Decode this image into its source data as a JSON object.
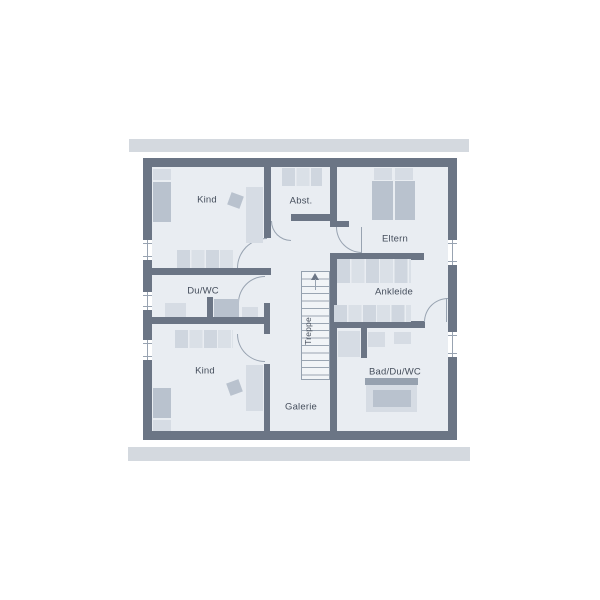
{
  "rooms": {
    "kind_top": {
      "label": "Kind"
    },
    "abstellraum": {
      "label": "Abst."
    },
    "eltern": {
      "label": "Eltern"
    },
    "du_wc": {
      "label": "Du/WC"
    },
    "ankleide": {
      "label": "Ankleide"
    },
    "treppe": {
      "label": "Treppe"
    },
    "bad_du_wc": {
      "label": "Bad/Du/WC"
    },
    "kind_bottom": {
      "label": "Kind"
    },
    "galerie": {
      "label": "Galerie"
    }
  },
  "colors": {
    "wall": "#6b7585",
    "room": "#e9edf2",
    "eaves": "#d4d9df",
    "furn-light": "#d6dce4",
    "furn-mid": "#b9c2ce",
    "furn-dark": "#96a1af",
    "line": "#98a3b1",
    "text": "#454e5c",
    "canvas": "#ffffff"
  }
}
